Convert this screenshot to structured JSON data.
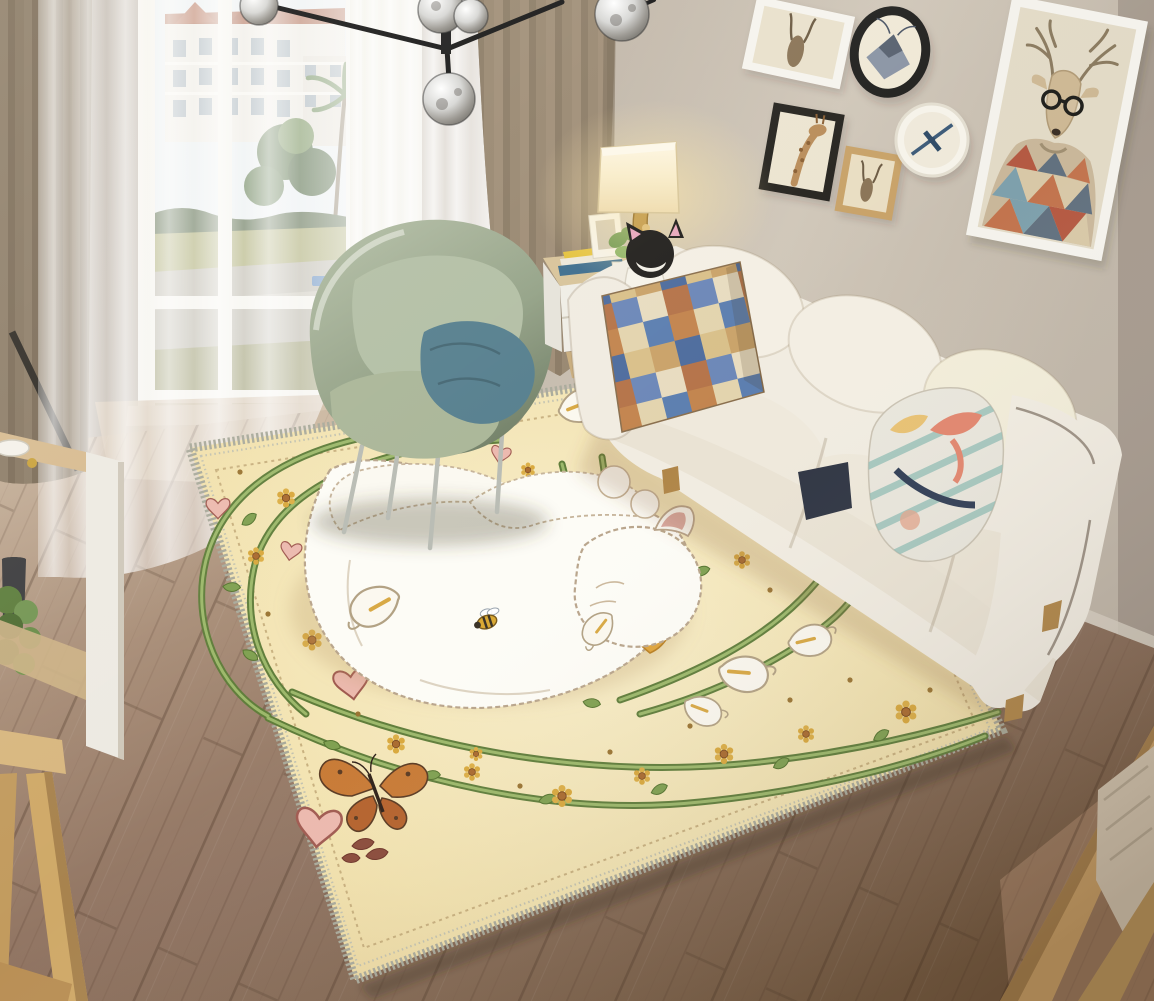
{
  "meta": {
    "domain": "natural-image",
    "kind": "product-photo"
  },
  "scene": {
    "alt": "Modern living room with a large cream cat-illustration area rug, white fabric sofa, sage green womb chair, sheer-curtained window, pendant globe chandelier and a gallery wall of animal art prints",
    "room_type": "living room"
  },
  "palette": {
    "wall": "#bfb4a6",
    "floor_wood": "#8d7160",
    "floor_sunlit": "#cdbaa3",
    "rug_base": "#f2e2ae",
    "rug_border_fringe": "#a9aa9b",
    "rug_vine_green": "#6f8f45",
    "rug_heart_pink": "#ecb9ae",
    "rug_flower_gold": "#d9a83c",
    "cat_white": "#fdfcf6",
    "cat_collar_orange": "#dfa43c",
    "sofa_cream": "#f1ece1",
    "armchair_sage": "#9aa88f",
    "pillow_teal": "#567f8e",
    "pillow_check_blue": "#5d7fb0",
    "pillow_check_orange": "#c3854f",
    "drape_tan": "#93836d",
    "sheer_white": "#ffffff",
    "chandelier_black": "#141414",
    "lamp_glow": "#ffe8a8"
  },
  "objects": {
    "rug": {
      "label": "cat illustration area rug",
      "alt": "Cream area rug with a sleeping white cat encircled by art-nouveau vines, calla lilies, daisies, pink hearts, a bee and a monarch butterfly, finished with a grey stitched fringe border"
    },
    "sofa": {
      "label": "cream three-seat sofa",
      "alt": "Cream fabric three-seat sofa with checkered pillow, black cat plush and pastel floral pillow"
    },
    "armchair": {
      "label": "sage womb chair",
      "alt": "Sage green womb chair with matching cushion and teal pillow on metal legs"
    },
    "side_table": {
      "label": "white side table",
      "alt": "White side table with books, photo frame, potted plant, teddy bear and a square-shade table lamp"
    },
    "chandelier": {
      "label": "globe pendant chandelier",
      "alt": "Black branch chandelier with mirrored glass globes"
    },
    "window": {
      "label": "window with sheer curtains",
      "alt": "Tall window with sheer white curtains and a view of white apartment buildings, palm trees and a road"
    },
    "gallery_wall": {
      "label": "gallery wall",
      "alt": "Six framed animal art prints: antelope sketches, a moth in a round black frame, a giraffe sketch, a wall clock and a large hipster deer in a geometric sweater"
    },
    "tv_cabinet": {
      "label": "white and wood cabinet",
      "alt": "Wood-topped white cabinet with bowl, dark vase and green plant"
    },
    "corner_chair": {
      "label": "wooden chair",
      "alt": "Light wood chair with beige cushion in the lower right corner"
    },
    "corner_table": {
      "label": "wooden cross-leg table",
      "alt": "Light wood cross-leg table corner in the lower left"
    }
  }
}
